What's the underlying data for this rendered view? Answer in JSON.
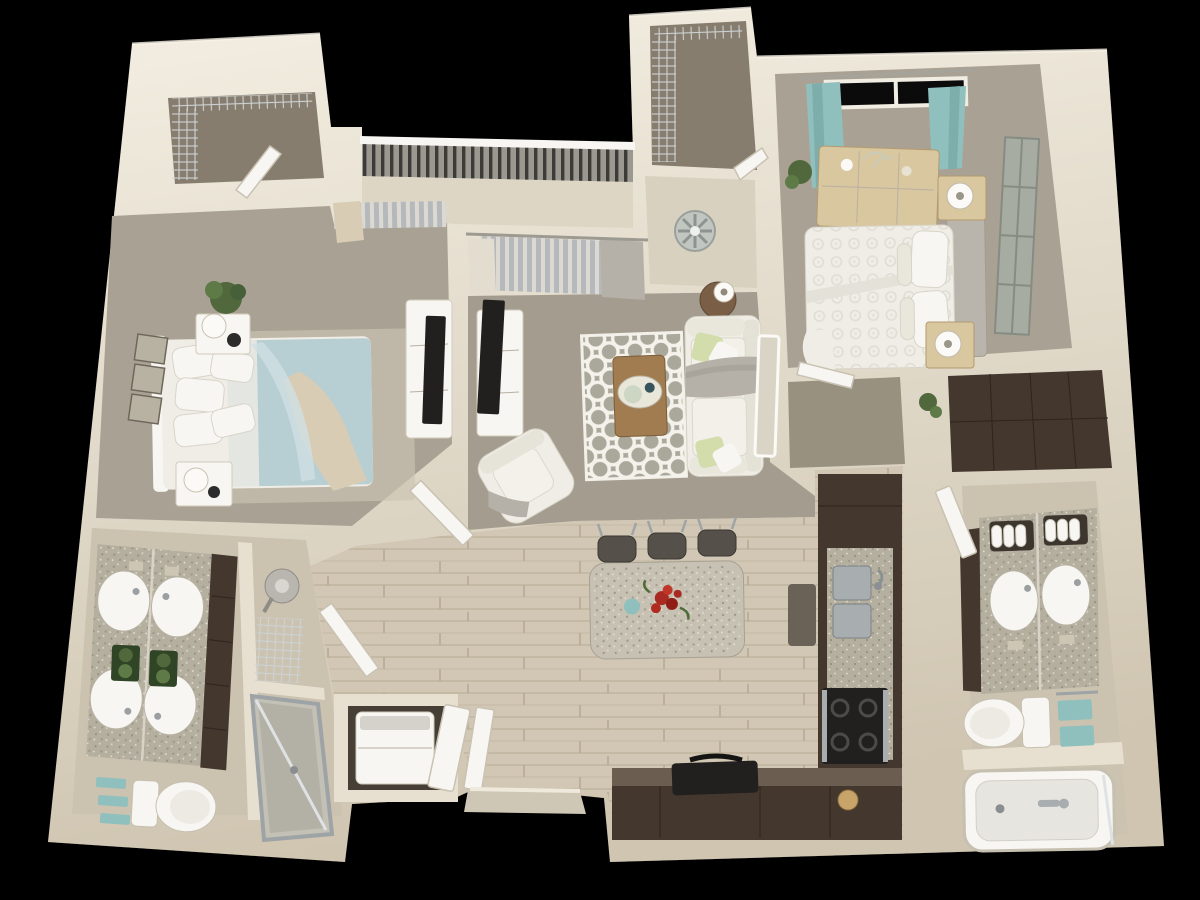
{
  "scene": {
    "title": "3D dollhouse-view apartment floor plan render",
    "view": "top-down 3d render on black background",
    "background": "#000000"
  },
  "palette": {
    "background": "#000000",
    "wall": "#e7dfd0",
    "wall_bright": "#f4efe3",
    "wall_shade": "#cfc5b1",
    "carpet_bedroom": "#a9a294",
    "carpet_living": "#a39c8f",
    "carpet_hall": "#98917f",
    "carpet_closet": "#867d6e",
    "balcony_floor": "#ded6c5",
    "nook_floor": "#d9d1c0",
    "wood_floor": "#d1c7b4",
    "wood_line": "#bcb09a",
    "tile_bath": "#cbc2b0",
    "dark_floor": "#453f36",
    "granite": "#b5afa0",
    "granite_light": "#c7c1b3",
    "cabinet_dark": "#44372e",
    "counter_brown": "#5a4c41",
    "appliance_black": "#21201e",
    "steel": "#a8adb0",
    "fixture_white": "#f7f6f3",
    "linen_white": "#efede6",
    "glass_gray": "#b6b9bb",
    "teal": "#8fc0bd",
    "bed_blue": "#b7ced3",
    "pillow_green": "#d3dcab",
    "plant_green": "#50683c",
    "flower_red": "#a82a20",
    "rug_base": "#aaa79b",
    "rug_white": "#f4f2ea",
    "wood_furniture": "#d9c7a0",
    "table_wood": "#a07c50",
    "throw_beige": "#d9ccb5",
    "throw_gray": "#b5b0a8",
    "art_gray": "#9ba096"
  },
  "rooms": [
    {
      "id": "bedroom-1",
      "label": "bedroom with blue bedding"
    },
    {
      "id": "bedroom-2",
      "label": "master bedroom with white bedding"
    },
    {
      "id": "living-room",
      "label": "living room"
    },
    {
      "id": "dining-kitchen",
      "label": "kitchen and dining area"
    },
    {
      "id": "bathroom-1",
      "label": "double-vanity bathroom with shower"
    },
    {
      "id": "bathroom-2",
      "label": "bathroom with tub"
    },
    {
      "id": "balcony",
      "label": "balcony with railing"
    },
    {
      "id": "walk-in-closet-1",
      "label": "wire-shelf closet top-left"
    },
    {
      "id": "walk-in-closet-2",
      "label": "wire-shelf closet top-center"
    },
    {
      "id": "laundry-closet",
      "label": "laundry closet with washer"
    },
    {
      "id": "hallway",
      "label": "carpeted hallway"
    },
    {
      "id": "entry",
      "label": "front entry"
    }
  ],
  "furniture": {
    "bedroom_1": [
      "bed-blue-duvet",
      "white-pillows",
      "beige-throw",
      "headboard",
      "nightstand-x2",
      "lamp-x2",
      "wall-frames-x3",
      "potted-plant-x2",
      "tv-console",
      "tv",
      "area-rug",
      "curtains-beige"
    ],
    "bedroom_2": [
      "bed-white-damask",
      "pillows",
      "gray-headboard",
      "nightstand-x2",
      "lamp-x2",
      "dresser",
      "window-teal-curtains",
      "wall-art-panels",
      "potted-plant"
    ],
    "living_room": [
      "sofa-cream",
      "green-pillows",
      "gray-throw",
      "quatrefoil-rug",
      "coffee-table",
      "decor-tray",
      "armchair",
      "tv-console",
      "tv",
      "side-table",
      "table-lamp",
      "ceiling-fan",
      "leaning-mirror",
      "sliding-door-curtains"
    ],
    "kitchen": [
      "island-granite",
      "bar-stool-x3",
      "red-flower-centerpiece",
      "double-sink",
      "range-stove",
      "l-shaped-counter",
      "dark-cabinets",
      "griddle",
      "bread-basket",
      "floor-mat"
    ],
    "bathroom_1": [
      "double-vanity-granite",
      "sink-x4-with-mirror-reflection",
      "plant-boxes",
      "linen-cabinet",
      "toilet",
      "teal-towels",
      "glass-shower",
      "wire-rack",
      "pedestal-fixture"
    ],
    "bathroom_2": [
      "vanity-granite",
      "sink-x2",
      "towel-rolls",
      "toilet",
      "teal-towels",
      "bathtub",
      "faucet"
    ],
    "closets": [
      "wire-shelving",
      "washer",
      "leaning-door-panel"
    ],
    "doors": [
      "open-white-door-x6",
      "front-door",
      "threshold"
    ]
  }
}
